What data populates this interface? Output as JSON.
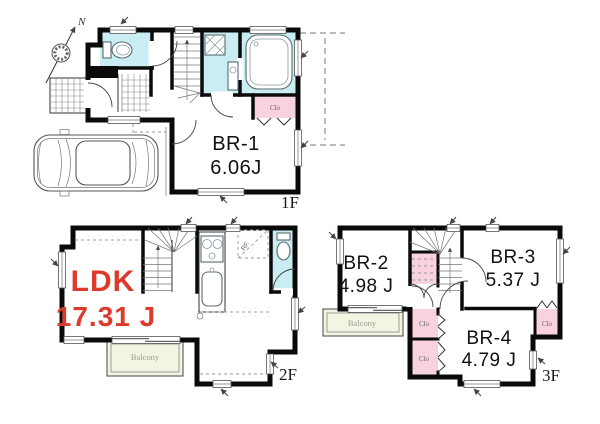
{
  "document": {
    "type": "residential-floor-plan",
    "background": "#ffffff"
  },
  "colors": {
    "wall": "#0a0a0a",
    "wet_area_fill": "#c9edf3",
    "closet_fill": "#f8d3dd",
    "balcony_fill": "#f3f5e2",
    "room_text": "#111111",
    "ldk_accent_text": "#dd3a2b",
    "floor_label_text": "#1a1a1a"
  },
  "compass": {
    "north_label": "N"
  },
  "floors": {
    "f1": {
      "floor_label": "1F",
      "rooms": [
        {
          "label": "BR-1",
          "area": "6.06J"
        }
      ],
      "closet_label": "Clo"
    },
    "f2": {
      "floor_label": "2F",
      "rooms": [
        {
          "label": "LDK",
          "area": "17.31 J"
        }
      ],
      "balcony_label": "Balcony",
      "fridge_label": "RF."
    },
    "f3": {
      "floor_label": "3F",
      "rooms": [
        {
          "label": "BR-2",
          "area": "4.98 J"
        },
        {
          "label": "BR-3",
          "area": "5.37 J"
        },
        {
          "label": "BR-4",
          "area": "4.79 J"
        }
      ],
      "closet_labels": [
        "Clo",
        "Clo",
        "Clo"
      ],
      "balcony_label": "Balcony"
    }
  }
}
